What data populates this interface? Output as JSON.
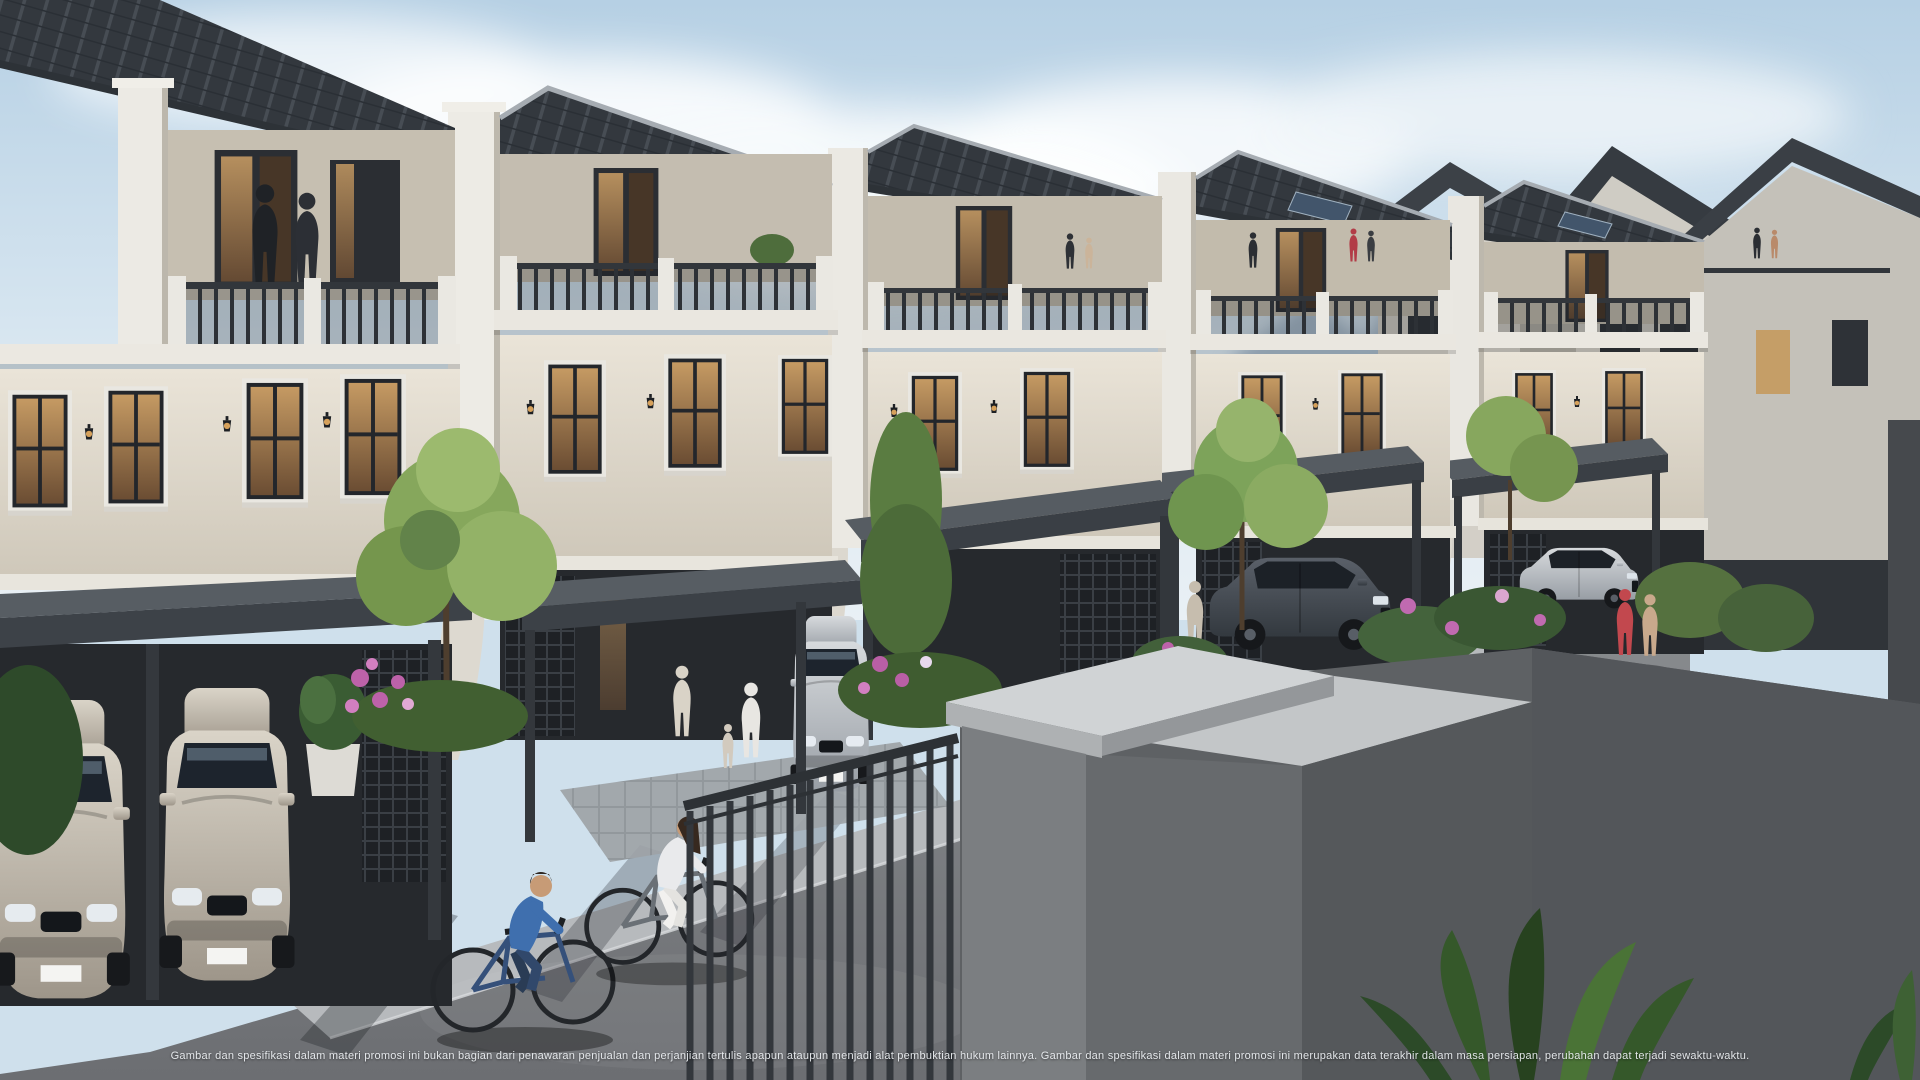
{
  "image": {
    "kind": "3D architectural marketing rendering",
    "subject": "Row of three-storey classic-modern townhouses with rooftop balconies, carports, landscaped front gardens and a street scene with cyclists",
    "elements": [
      "sky with clouds",
      "hazy mountains",
      "townhouse row with dark ribbed roofs",
      "background house block",
      "carports with parked cars",
      "ornamental trees and pink flower beds",
      "asphalt street with tree shadows",
      "metal railing fence and concrete gate pillar in foreground",
      "tropical plants"
    ]
  },
  "palette": {
    "sky_top": "#b6d0e4",
    "sky_bottom": "#e6eef4",
    "mountain": "#8fa6ba",
    "roof_dark": "#33383e",
    "roof_rib": "#474d54",
    "facade_cream": "#e0dacd",
    "facade_shadow": "#c3bcae",
    "trim_white": "#eae7e0",
    "window_frame": "#23262b",
    "window_glow": "#c59a63",
    "canopy": "#3a3f45",
    "carport_interior": "#26292d",
    "road": "#7d8084",
    "sidewalk": "#b7babd",
    "foliage": "#7da35a",
    "foliage_dark": "#3f5c30",
    "flower_pink": "#bd62a9",
    "car_champagne": "#cfc8bc",
    "car_silver": "#c6c9cc",
    "suv_dark": "#49505a",
    "wall_light": "#d0d3d5",
    "wall_shadow": "#5e6164",
    "railing": "#33373c"
  },
  "scene": {
    "houses": {
      "count": 6,
      "storeys": 3,
      "roof": "dark charcoal ribbed tile, mono-pitch with white party-wall pilasters",
      "features": [
        "rooftop balcony with white posts and dark metal railing",
        "tall dark-framed windows with warm interior light",
        "classical cornice bands",
        "wall lanterns",
        "dark carport canopy with slim posts",
        "lattice screen walls",
        "curved white garden walls"
      ]
    },
    "vehicles": [
      {
        "id": "car-champagne-1",
        "type": "city car",
        "color": "champagne silver",
        "location": "far-left carport"
      },
      {
        "id": "car-champagne-2",
        "type": "city car",
        "color": "champagne silver",
        "location": "left carport"
      },
      {
        "id": "car-silver-center",
        "type": "sedan",
        "color": "silver",
        "location": "center carport"
      },
      {
        "id": "suv-dark",
        "type": "SUV",
        "color": "dark grey",
        "location": "right-center carport"
      },
      {
        "id": "car-silver-right",
        "type": "hatchback",
        "color": "silver",
        "location": "far-right carport"
      }
    ],
    "people": [
      {
        "id": "balcony-couple",
        "location": "left rooftop balcony"
      },
      {
        "id": "terrace-figures",
        "location": "right rooftop terraces"
      },
      {
        "id": "woman-by-entrance",
        "location": "center house entrance"
      },
      {
        "id": "man-and-child-by-car",
        "location": "center carport driveway"
      },
      {
        "id": "person-by-suv",
        "location": "right-center carport"
      },
      {
        "id": "walking-women",
        "location": "right sidewalk, one in red"
      },
      {
        "id": "cyclist-blue",
        "location": "street, blue shirt"
      },
      {
        "id": "cyclist-white",
        "location": "street, white outfit"
      }
    ]
  },
  "footer": {
    "disclaimer": "Gambar dan spesifikasi dalam materi promosi ini bukan bagian dari penawaran penjualan dan perjanjian tertulis apapun ataupun menjadi alat pembuktian hukum lainnya.  Gambar dan spesifikasi dalam materi promosi ini merupakan data terakhir dalam masa persiapan, perubahan dapat terjadi sewaktu-waktu."
  }
}
